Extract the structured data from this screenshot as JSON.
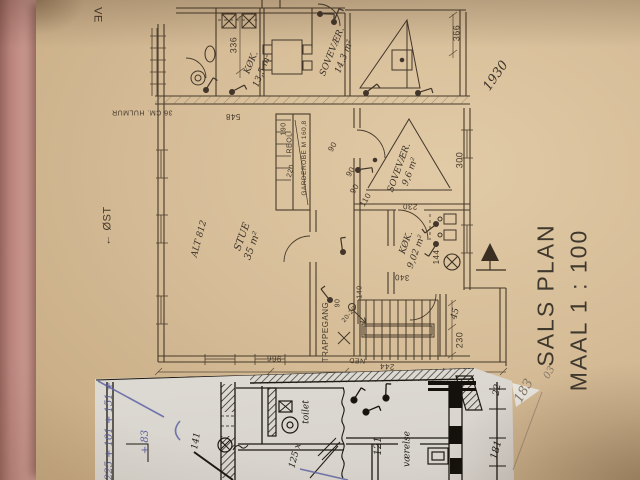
{
  "colors": {
    "paper_tan": "#d6bd98",
    "scrap_paper": "#e2dfd9",
    "plan_ink": "#46392a",
    "scrap_ink": "#1c1813",
    "pink_edge": "#c7948b",
    "blue_pen": "#5d63a2",
    "pencil": "#857767"
  },
  "title_block": {
    "line1": "SALS PLAN",
    "line2": "MAAL 1 : 100"
  },
  "labels": [
    {
      "name": "ve",
      "text": "VE",
      "x": 97,
      "y": 15,
      "rot": 90,
      "size": 11,
      "cls": "lab-print",
      "layer": 1
    },
    {
      "name": "dim-336",
      "text": "336",
      "x": 234,
      "y": 45,
      "rot": -90,
      "size": 9,
      "cls": "lab-print",
      "layer": 1
    },
    {
      "name": "room-koekken-13",
      "text": "KØK.",
      "x": 252,
      "y": 63,
      "rot": -68,
      "size": 9,
      "cls": "lab-hand",
      "layer": 1
    },
    {
      "name": "room-koekken-13-area",
      "text": "13,5 m²",
      "x": 263,
      "y": 71,
      "rot": -68,
      "size": 9,
      "cls": "lab-hand",
      "layer": 1
    },
    {
      "name": "room-sovevaer-14",
      "text": "SOVEVÆR.",
      "x": 333,
      "y": 52,
      "rot": -68,
      "size": 9,
      "cls": "lab-hand",
      "layer": 1
    },
    {
      "name": "room-sovevaer-14-area",
      "text": "14,3 m²",
      "x": 345,
      "y": 57,
      "rot": -68,
      "size": 9,
      "cls": "lab-hand",
      "layer": 1
    },
    {
      "name": "dim-366",
      "text": "366",
      "x": 457,
      "y": 33,
      "rot": -90,
      "size": 9,
      "cls": "lab-print",
      "layer": 1
    },
    {
      "name": "note-1930",
      "text": "1930",
      "x": 496,
      "y": 76,
      "rot": -55,
      "size": 13,
      "cls": "lab-hand",
      "layer": 1
    },
    {
      "name": "note-hulmur",
      "text": "36 CM. HULMUR",
      "x": 142,
      "y": 112,
      "rot": 180,
      "size": 7,
      "cls": "lab-print",
      "layer": 1
    },
    {
      "name": "dim-548",
      "text": "548",
      "x": 233,
      "y": 116,
      "rot": 180,
      "size": 8,
      "cls": "lab-print",
      "layer": 1
    },
    {
      "name": "dim-190",
      "text": "190",
      "x": 284,
      "y": 129,
      "rot": -90,
      "size": 7,
      "cls": "lab-print",
      "layer": 1
    },
    {
      "name": "label-reol",
      "text": "REOL",
      "x": 290,
      "y": 143,
      "rot": -90,
      "size": 7,
      "cls": "lab-print",
      "layer": 1
    },
    {
      "name": "label-garderobe",
      "text": "GARDEROBE M 160,8",
      "x": 305,
      "y": 158,
      "rot": -90,
      "size": 6.5,
      "cls": "lab-print",
      "layer": 1
    },
    {
      "name": "dim-220",
      "text": "220",
      "x": 291,
      "y": 171,
      "rot": -75,
      "size": 7,
      "cls": "lab-print",
      "layer": 1
    },
    {
      "name": "dim-90-a",
      "text": "90",
      "x": 333,
      "y": 147,
      "rot": -60,
      "size": 8,
      "cls": "lab-print",
      "layer": 1
    },
    {
      "name": "dim-90-b",
      "text": "90",
      "x": 351,
      "y": 172,
      "rot": -60,
      "size": 8,
      "cls": "lab-print",
      "layer": 1
    },
    {
      "name": "dim-90-c",
      "text": "90",
      "x": 355,
      "y": 189,
      "rot": -60,
      "size": 8,
      "cls": "lab-print",
      "layer": 1
    },
    {
      "name": "dim-110",
      "text": "110",
      "x": 366,
      "y": 200,
      "rot": -60,
      "size": 8,
      "cls": "lab-print",
      "layer": 1
    },
    {
      "name": "room-sovevaer-9",
      "text": "SOVEVÆR.",
      "x": 400,
      "y": 168,
      "rot": -70,
      "size": 9,
      "cls": "lab-hand",
      "layer": 1
    },
    {
      "name": "room-sovevaer-9-area",
      "text": "9,6 m²",
      "x": 411,
      "y": 172,
      "rot": -70,
      "size": 9,
      "cls": "lab-hand",
      "layer": 1
    },
    {
      "name": "dim-300",
      "text": "300",
      "x": 460,
      "y": 160,
      "rot": -90,
      "size": 9,
      "cls": "lab-print",
      "layer": 1
    },
    {
      "name": "dim-230-a",
      "text": "230",
      "x": 410,
      "y": 206,
      "rot": 183,
      "size": 8,
      "cls": "lab-print",
      "layer": 1
    },
    {
      "name": "compass-oest",
      "text": "← ØST",
      "x": 108,
      "y": 226,
      "rot": -90,
      "size": 11,
      "cls": "lab-print",
      "layer": 1
    },
    {
      "name": "note-alt-812",
      "text": "ALT 812",
      "x": 200,
      "y": 239,
      "rot": -75,
      "size": 9,
      "cls": "lab-hand",
      "layer": 1
    },
    {
      "name": "room-stue",
      "text": "STUE",
      "x": 243,
      "y": 237,
      "rot": -70,
      "size": 10,
      "cls": "lab-hand",
      "layer": 1
    },
    {
      "name": "room-stue-area",
      "text": "35 m²",
      "x": 253,
      "y": 246,
      "rot": -70,
      "size": 10,
      "cls": "lab-hand",
      "layer": 1
    },
    {
      "name": "room-koekken-9",
      "text": "KØK.",
      "x": 407,
      "y": 243,
      "rot": -70,
      "size": 9,
      "cls": "lab-hand",
      "layer": 1
    },
    {
      "name": "room-koekken-9-area",
      "text": "9,02 m²",
      "x": 417,
      "y": 252,
      "rot": -70,
      "size": 9,
      "cls": "lab-hand",
      "layer": 1
    },
    {
      "name": "dim-144",
      "text": "144",
      "x": 437,
      "y": 257,
      "rot": -90,
      "size": 8,
      "cls": "lab-print",
      "layer": 1
    },
    {
      "name": "dim-340",
      "text": "340",
      "x": 402,
      "y": 277,
      "rot": 183,
      "size": 8,
      "cls": "lab-print",
      "layer": 1
    },
    {
      "name": "label-trappegang",
      "text": "TRAPPEGANG",
      "x": 326,
      "y": 332,
      "rot": -90,
      "size": 8,
      "cls": "lab-print",
      "layer": 1
    },
    {
      "name": "dim-90-d",
      "text": "90",
      "x": 338,
      "y": 303,
      "rot": -90,
      "size": 7,
      "cls": "lab-print",
      "layer": 1
    },
    {
      "name": "dim-20-20",
      "text": "20-20",
      "x": 350,
      "y": 315,
      "rot": -50,
      "size": 6.5,
      "cls": "lab-print",
      "layer": 1
    },
    {
      "name": "dim-140",
      "text": "140",
      "x": 360,
      "y": 292,
      "rot": -90,
      "size": 7,
      "cls": "lab-print",
      "layer": 1
    },
    {
      "name": "label-ned",
      "text": "NED",
      "x": 357,
      "y": 360,
      "rot": 183,
      "size": 7,
      "cls": "lab-print",
      "layer": 1
    },
    {
      "name": "dim-244",
      "text": "244",
      "x": 387,
      "y": 366,
      "rot": 183,
      "size": 8,
      "cls": "lab-print",
      "layer": 1
    },
    {
      "name": "dim-966",
      "text": "966",
      "x": 274,
      "y": 358,
      "rot": 183,
      "size": 8,
      "cls": "lab-print",
      "layer": 1
    },
    {
      "name": "dim-45",
      "text": "45",
      "x": 456,
      "y": 314,
      "rot": -75,
      "size": 9,
      "cls": "lab-hand",
      "layer": 1
    },
    {
      "name": "dim-230-b",
      "text": "230",
      "x": 460,
      "y": 340,
      "rot": -90,
      "size": 9,
      "cls": "lab-print",
      "layer": 1
    },
    {
      "name": "calc-sum",
      "text": "225 + 101 + 151 +",
      "x": 110,
      "y": 431,
      "rot": -90,
      "size": 10,
      "cls": "lab-blue",
      "layer": 2
    },
    {
      "name": "calc-83",
      "text": "+ 83",
      "x": 146,
      "y": 442,
      "rot": -90,
      "size": 10,
      "cls": "lab-blue",
      "layer": 2
    },
    {
      "name": "dim-141",
      "text": "141",
      "x": 197,
      "y": 441,
      "rot": -80,
      "size": 9,
      "cls": "lab-ink",
      "layer": 2
    },
    {
      "name": "label-toilet",
      "text": "toilet",
      "x": 307,
      "y": 412,
      "rot": -90,
      "size": 9,
      "cls": "lab-ink",
      "layer": 2
    },
    {
      "name": "note-125",
      "text": "125 x",
      "x": 296,
      "y": 456,
      "rot": -75,
      "size": 9,
      "cls": "lab-ink",
      "layer": 2
    },
    {
      "name": "label-vaerelse",
      "text": "værelse",
      "x": 408,
      "y": 449,
      "rot": -90,
      "size": 9,
      "cls": "lab-ink",
      "layer": 2
    },
    {
      "name": "note-121",
      "text": "121",
      "x": 379,
      "y": 446,
      "rot": -90,
      "size": 10,
      "cls": "lab-ink",
      "layer": 2
    },
    {
      "name": "dim-22",
      "text": "22",
      "x": 498,
      "y": 390,
      "rot": -80,
      "size": 9,
      "cls": "lab-ink",
      "layer": 2
    },
    {
      "name": "dim-181",
      "text": "181",
      "x": 497,
      "y": 450,
      "rot": -75,
      "size": 10,
      "cls": "lab-ink",
      "layer": 2
    },
    {
      "name": "note-183",
      "text": "183",
      "x": 524,
      "y": 391,
      "rot": -60,
      "size": 13,
      "cls": "lab-pencil",
      "layer": 2
    },
    {
      "name": "note-03",
      "text": "03",
      "x": 550,
      "y": 373,
      "rot": -60,
      "size": 10,
      "cls": "lab-pencil",
      "layer": 2
    }
  ]
}
